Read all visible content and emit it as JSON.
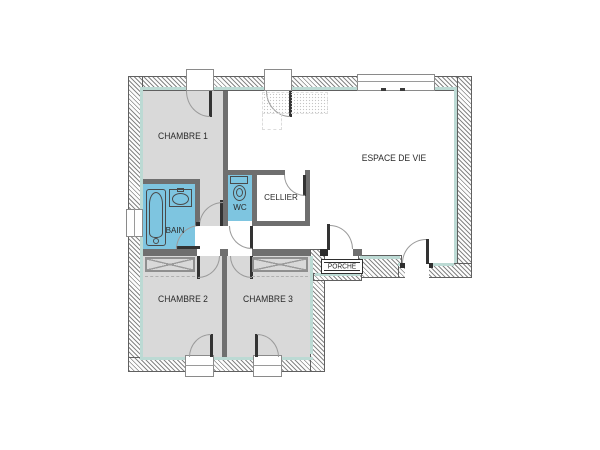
{
  "rooms": {
    "chambre1": {
      "label": "CHAMBRE 1"
    },
    "chambre2": {
      "label": "CHAMBRE 2"
    },
    "chambre3": {
      "label": "CHAMBRE 3"
    },
    "bain": {
      "label": "BAIN"
    },
    "wc": {
      "label": "WC"
    },
    "cellier": {
      "label": "CELLIER"
    },
    "espace_de_vie": {
      "label": "ESPACE DE VIE"
    },
    "porche": {
      "label": "PORCHE"
    }
  },
  "colors": {
    "room_fill_gray": "#d9d9d9",
    "wet_room_blue": "#7ec5e0",
    "insulation_teal": "#bcdad4",
    "interior_wall": "#6f6f6f",
    "wall_edge": "#606060",
    "door_arc": "#9a9a9a",
    "label_text": "#2a2a2a"
  }
}
